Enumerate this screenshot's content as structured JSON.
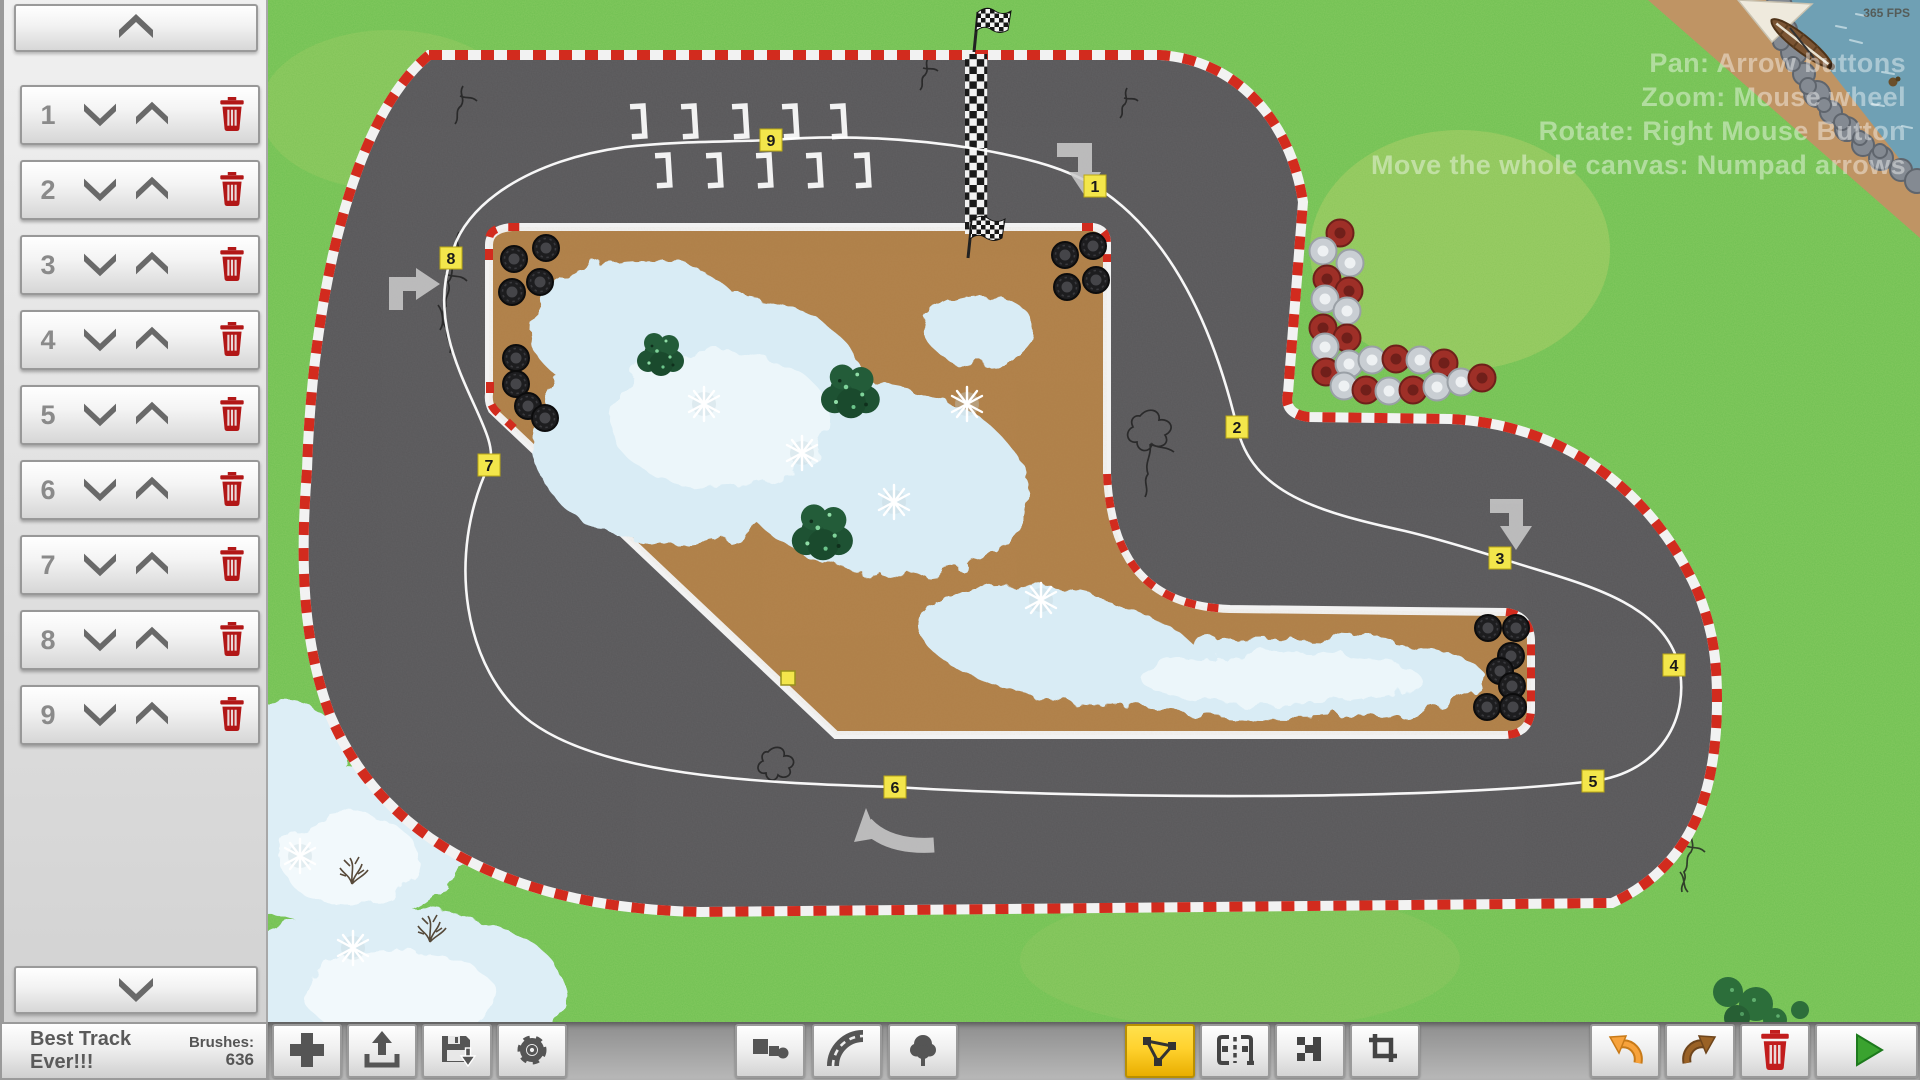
{
  "window": {
    "fps": "365 FPS"
  },
  "sidebar": {
    "scroll_up_icon": "chevron-up-icon",
    "scroll_down_icon": "chevron-down-icon",
    "items": [
      {
        "label": "1"
      },
      {
        "label": "2"
      },
      {
        "label": "3"
      },
      {
        "label": "4"
      },
      {
        "label": "5"
      },
      {
        "label": "6"
      },
      {
        "label": "7"
      },
      {
        "label": "8"
      },
      {
        "label": "9"
      }
    ],
    "row_icons": [
      "move-down-chevron-icon",
      "move-up-chevron-icon",
      "trash-icon"
    ]
  },
  "status": {
    "track_name": "Best Track Ever!!!",
    "brushes_label": "Brushes:",
    "brushes_count": "636"
  },
  "toolbar": {
    "tools": [
      {
        "icon": "plus-icon"
      },
      {
        "icon": "load-icon"
      },
      {
        "icon": "save-icon"
      },
      {
        "icon": "settings-gear-icon"
      },
      {
        "icon": "shapes-brush-icon"
      },
      {
        "icon": "road-curve-icon"
      },
      {
        "icon": "tree-icon"
      },
      {
        "icon": "waypoint-path-icon",
        "active": true
      },
      {
        "icon": "start-grid-icon"
      },
      {
        "icon": "finish-checker-icon"
      },
      {
        "icon": "crop-icon"
      },
      {
        "icon": "undo-icon"
      },
      {
        "icon": "redo-icon"
      },
      {
        "icon": "trash-icon"
      },
      {
        "icon": "play-icon"
      }
    ]
  },
  "canvas": {
    "instructions": [
      "Pan: Arrow buttons",
      "Zoom: Mouse wheel",
      "Rotate: Right Mouse Button",
      "Move the whole canvas: Numpad arrows"
    ],
    "waypoints": [
      {
        "n": "1",
        "x": 1095,
        "y": 186
      },
      {
        "n": "2",
        "x": 1237,
        "y": 427
      },
      {
        "n": "3",
        "x": 1500,
        "y": 558
      },
      {
        "n": "4",
        "x": 1674,
        "y": 665
      },
      {
        "n": "5",
        "x": 1593,
        "y": 781
      },
      {
        "n": "6",
        "x": 895,
        "y": 787
      },
      {
        "n": "7",
        "x": 489,
        "y": 465
      },
      {
        "n": "8",
        "x": 451,
        "y": 258
      },
      {
        "n": "9",
        "x": 771,
        "y": 140
      }
    ],
    "colors": {
      "grass": "#6fc052",
      "asphalt": "#59585a",
      "dirt": "#b08049",
      "curb_red": "#d22b1e",
      "snow": "#d9ecf5",
      "waypoint_yellow": "#f3e64b",
      "active_tool": "#ffd22e",
      "water": "#6fa0b4"
    }
  }
}
